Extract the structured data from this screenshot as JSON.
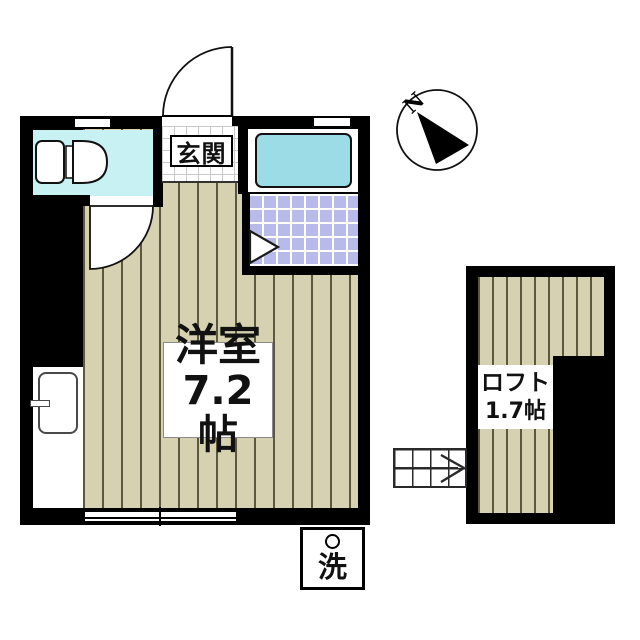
{
  "plan": {
    "main_room": {
      "name": "洋室",
      "size": "7.2帖"
    },
    "loft": {
      "name": "ロフト",
      "size": "1.7帖"
    },
    "entrance": {
      "name": "玄関"
    },
    "laundry": {
      "symbol": "洗"
    },
    "compass": {
      "north_label": "N"
    }
  },
  "colors": {
    "wall": "#000000",
    "floor_stripe_base": "#d6d2b1",
    "floor_stripe_line": "#5b583e",
    "toilet_room": "#c8f1f4",
    "bathtub": "#9cdce6",
    "tile_room": "#b8bbea",
    "background": "#ffffff"
  }
}
